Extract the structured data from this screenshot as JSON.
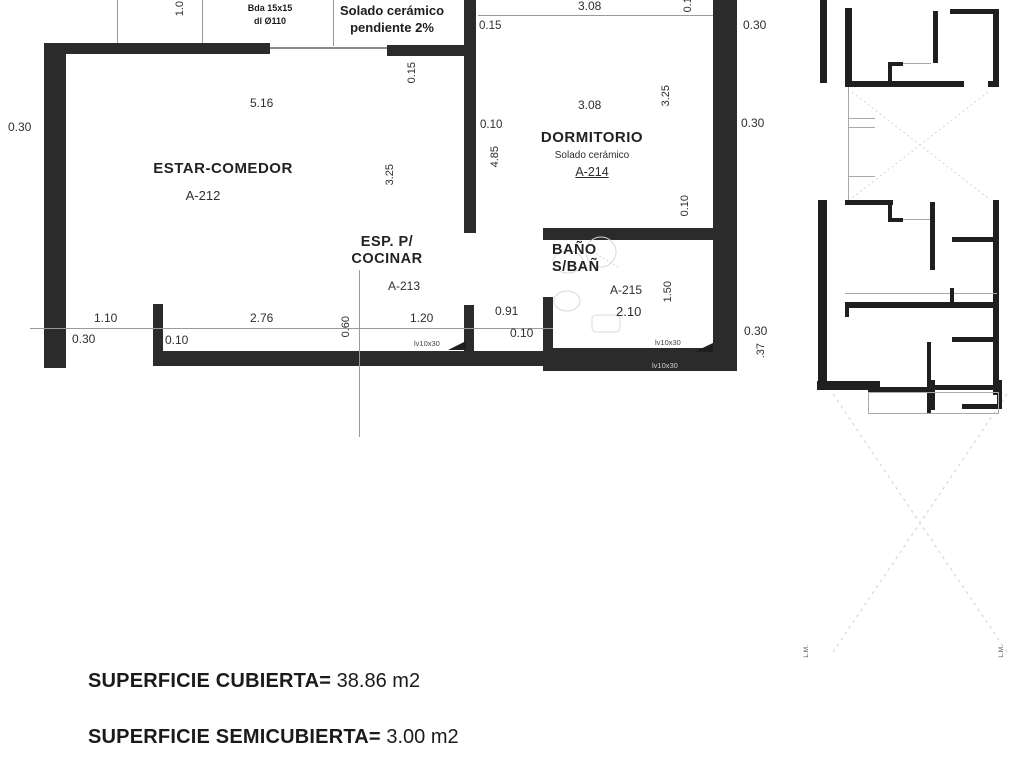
{
  "colors": {
    "wall": "#2b2b2b",
    "dim_text": "#2e2e2e",
    "faint_line": "#d8d8d8"
  },
  "rooms": {
    "estar_comedor": {
      "name": "ESTAR-COMEDOR",
      "code": "A-212"
    },
    "esp_cocinar": {
      "line1": "ESP. P/",
      "line2": "COCINAR",
      "code": "A-213"
    },
    "dormitorio": {
      "name": "DORMITORIO",
      "floor": "Solado cerámico",
      "code": "A-214"
    },
    "bano": {
      "line1": "BAÑO",
      "line2": "S/BAÑ",
      "code": "A-215"
    }
  },
  "notes": {
    "drain_line1": "Bda 15x15",
    "drain_line2": "dl Ø110",
    "ceramic_line1": "Solado cerámico",
    "ceramic_line2": "pendiente 2%",
    "beam": "lv10x30",
    "lm": "L.M."
  },
  "dims": {
    "top_offset": "1.0",
    "wall_015_a": "0.15",
    "wall_015_b": "0.15",
    "dorm_width_top": "3.08",
    "wall_010_top": "0.10",
    "right_030_a": "0.30",
    "left_030": "0.30",
    "estar_width": "5.16",
    "estar_height": "3.25",
    "pasillo_height": "4.85",
    "wall_010_mid": "0.10",
    "dorm_width": "3.08",
    "dorm_height": "3.25",
    "right_030_b": "0.30",
    "wall_010_dorm": "0.10",
    "bano_width": "2.10",
    "bano_height": "1.50",
    "cocina_bano": "0.91",
    "wall_010_bano": "0.10",
    "bottom_110": "1.10",
    "bottom_030": "0.30",
    "bottom_010": "0.10",
    "bottom_276": "2.76",
    "bottom_060": "0.60",
    "bottom_120": "1.20",
    "right_030_c": "0.30",
    "beam_height": ".37"
  },
  "summary": {
    "cubierta_label": "SUPERFICIE CUBIERTA=",
    "cubierta_value": "38.86 m2",
    "semicubierta_label": "SUPERFICIE SEMICUBIERTA=",
    "semicubierta_value": "3.00 m2"
  }
}
